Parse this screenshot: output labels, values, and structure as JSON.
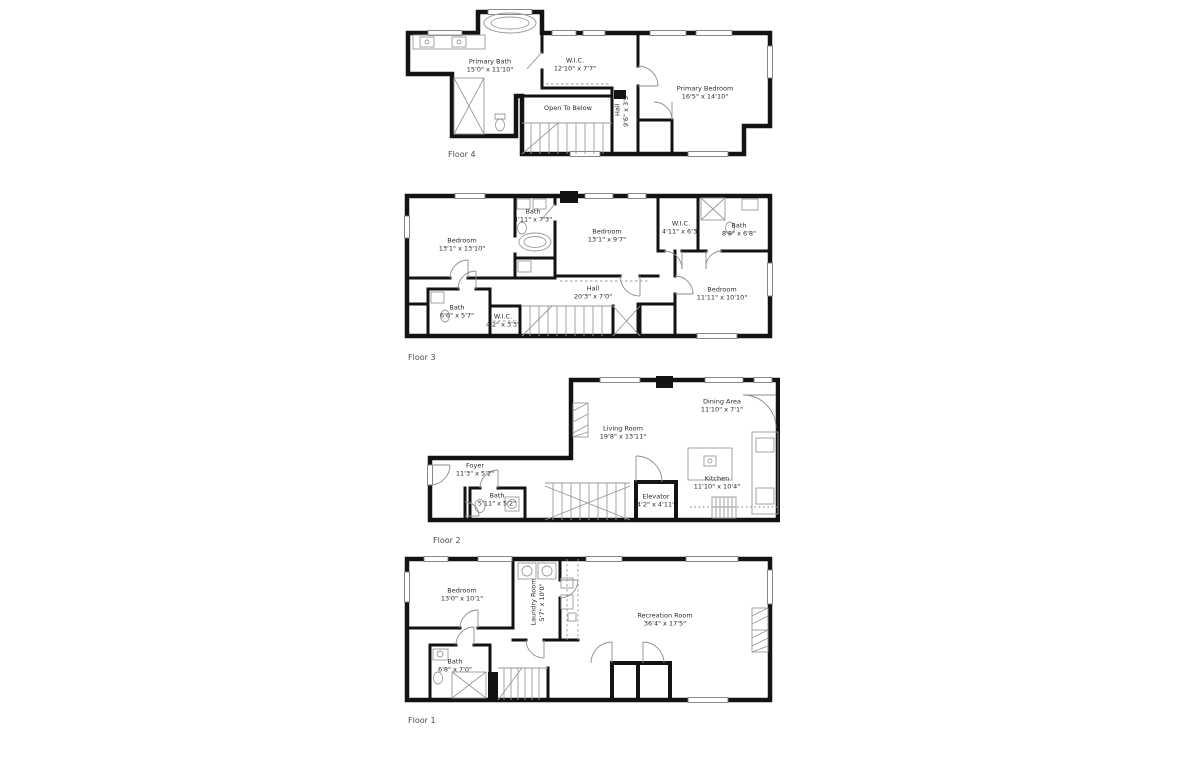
{
  "colors": {
    "wall": "#131313",
    "thin_line": "#9a9a9a",
    "background": "#ffffff",
    "text": "#2b2b2b"
  },
  "floors": [
    {
      "label": "Floor 4",
      "rooms": [
        {
          "name": "Primary Bath",
          "dims": "15'0\" x 11'10\""
        },
        {
          "name": "W.I.C.",
          "dims": "12'10\" x 7'7\""
        },
        {
          "name": "Primary Bedroom",
          "dims": "16'5\" x 14'10\""
        },
        {
          "name": "Open To Below",
          "dims": ""
        },
        {
          "name": "Hall",
          "dims": "9'6\" x 3'5\""
        }
      ]
    },
    {
      "label": "Floor 3",
      "rooms": [
        {
          "name": "Bedroom",
          "dims": "13'1\" x 13'10\""
        },
        {
          "name": "Bath",
          "dims": "4'11\" x 7'3\""
        },
        {
          "name": "Bedroom",
          "dims": "13'1\" x 9'7\""
        },
        {
          "name": "W.I.C.",
          "dims": "4'11\" x 6'3\""
        },
        {
          "name": "Bath",
          "dims": "8'8\" x 6'8\""
        },
        {
          "name": "Hall",
          "dims": "20'3\" x 7'0\""
        },
        {
          "name": "Bedroom",
          "dims": "11'11\" x 10'10\""
        },
        {
          "name": "Bath",
          "dims": "6'6\" x 5'7\""
        },
        {
          "name": "W.I.C.",
          "dims": "4'2\" x 3'3\""
        }
      ]
    },
    {
      "label": "Floor 2",
      "rooms": [
        {
          "name": "Living Room",
          "dims": "19'8\" x 13'11\""
        },
        {
          "name": "Dining Area",
          "dims": "11'10\" x 7'1\""
        },
        {
          "name": "Kitchen",
          "dims": "11'10\" x 10'4\""
        },
        {
          "name": "Foyer",
          "dims": "11'3\" x 5'2\""
        },
        {
          "name": "Bath",
          "dims": "5'11\" x 5'2\""
        },
        {
          "name": "Elevator",
          "dims": "4'2\" x 4'11\""
        }
      ]
    },
    {
      "label": "Floor 1",
      "rooms": [
        {
          "name": "Bedroom",
          "dims": "13'0\" x 10'1\""
        },
        {
          "name": "Laundry Room",
          "dims": "5'7\" x 10'0\""
        },
        {
          "name": "Recreation Room",
          "dims": "36'4\" x 17'5\""
        },
        {
          "name": "Bath",
          "dims": "6'8\" x 7'0\""
        }
      ]
    }
  ]
}
